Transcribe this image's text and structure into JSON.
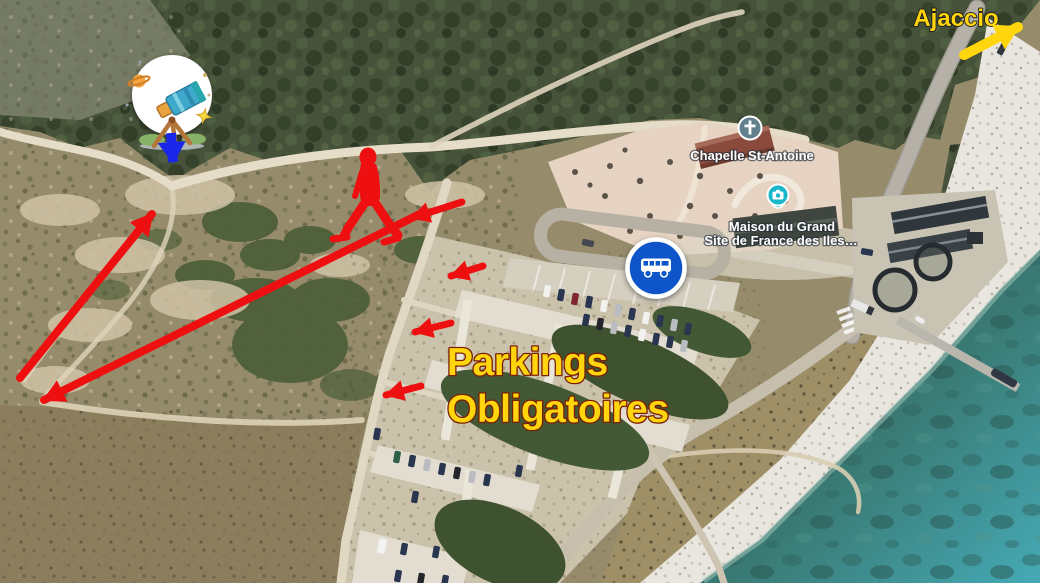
{
  "map": {
    "destination_sign": {
      "label": "Ajaccio"
    },
    "parking_annotation": {
      "line1": "Parkings",
      "line2": "Obligatoires"
    },
    "poi_labels": {
      "chapel": "Chapelle St-Antoine",
      "maison_line1": "Maison du Grand",
      "maison_line2": "Site de France des Iles…"
    },
    "colors": {
      "annotation_yellow": "#ffd60d",
      "annotation_red": "#ee1010",
      "arrow_blue": "#1b27e8",
      "bus_sign_blue": "#0a55c9",
      "poi_pin_teal": "#17b6c9",
      "poi_icon_slate": "#63808f",
      "label_white": "#ffffff"
    },
    "icons": {
      "viewpoint_badge": "telescope-stargazing-icon",
      "viewpoint_arrow": "blue-down-arrow",
      "walking_route": "red-walking-person",
      "bus_stop": "bus-road-sign",
      "chapel": "church-cross-poi-icon",
      "maison": "camera-photo-poi-pin",
      "destination_arrow": "yellow-up-right-arrow",
      "route_arrows": "red-route-arrows"
    }
  }
}
